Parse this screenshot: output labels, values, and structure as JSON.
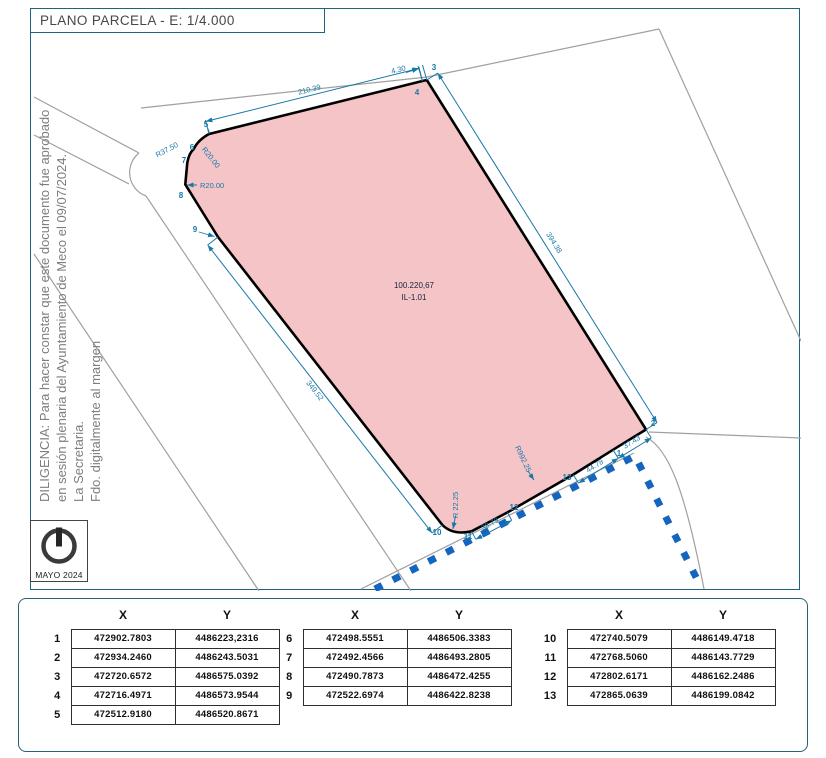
{
  "title": "PLANO PARCELA - E: 1/4.000",
  "diligencia": {
    "line1": "DILIGENCIA: Para hacer constar que este documento fue aprobado",
    "line2": "en sesión plenaria del Ayuntamiento de Meco el 09/07/2024.",
    "line3": "La Secretaria.",
    "line4": "Fdo. digitalmente al margen"
  },
  "north": {
    "date": "MAYO 2024"
  },
  "map": {
    "area_value": "100.220,67",
    "area_code": "IL-1.01",
    "dims": {
      "top": "210.39",
      "top_corner": "4.30",
      "right": "394.38",
      "left": "349.52",
      "seg_13_1": "44.78",
      "seg_1_2": "37.43",
      "seg_11_12": "38.79",
      "radius_corner": "R 22.25",
      "radius_long": "R992.25",
      "radius_37": "R37.50",
      "radius_20a": "R20.00",
      "radius_20b": "R20.00"
    }
  },
  "table": {
    "col_x": "X",
    "col_y": "Y",
    "groups": [
      {
        "rows": [
          {
            "n": "1",
            "x": "472902.7803",
            "y": "4486223,2316"
          },
          {
            "n": "2",
            "x": "472934.2460",
            "y": "4486243.5031"
          },
          {
            "n": "3",
            "x": "472720.6572",
            "y": "4486575.0392"
          },
          {
            "n": "4",
            "x": "472716.4971",
            "y": "4486573.9544"
          },
          {
            "n": "5",
            "x": "472512.9180",
            "y": "4486520.8671"
          }
        ]
      },
      {
        "rows": [
          {
            "n": "6",
            "x": "472498.5551",
            "y": "4486506.3383"
          },
          {
            "n": "7",
            "x": "472492.4566",
            "y": "4486493.2805"
          },
          {
            "n": "8",
            "x": "472490.7873",
            "y": "4486472.4255"
          },
          {
            "n": "9",
            "x": "472522.6974",
            "y": "4486422.8238"
          }
        ]
      },
      {
        "rows": [
          {
            "n": "10",
            "x": "472740.5079",
            "y": "4486149.4718"
          },
          {
            "n": "11",
            "x": "472768.5060",
            "y": "4486143.7729"
          },
          {
            "n": "12",
            "x": "472802.6171",
            "y": "4486162.2486"
          },
          {
            "n": "13",
            "x": "472865.0639",
            "y": "4486199.0842"
          }
        ]
      }
    ]
  },
  "colors": {
    "parcel_fill": "#f5c4c7",
    "dimension_blue": "#1878a8",
    "boundary_dash_blue": "#1565c0",
    "frame_teal": "#1d637f",
    "road_gray": "#a0a0a0"
  }
}
